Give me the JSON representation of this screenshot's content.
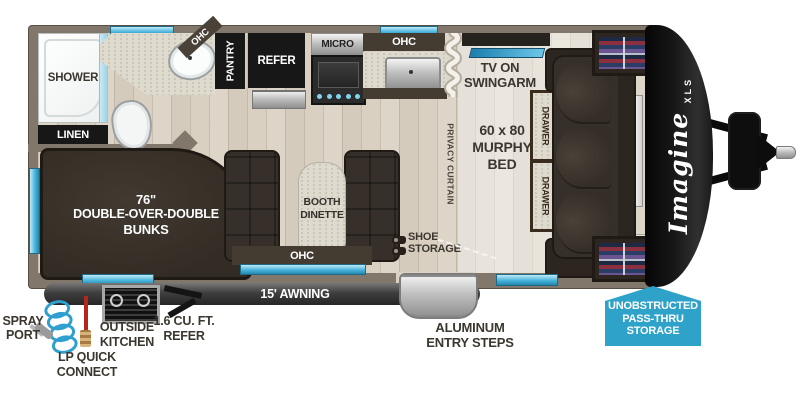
{
  "labels": {
    "shower": "SHOWER",
    "linen": "LINEN",
    "bath_ohc": "OHC",
    "pantry": "PANTRY",
    "refer": "REFER",
    "micro": "MICRO",
    "kitchen_ohc": "OHC",
    "privacy": "PRIVACY CURTAIN",
    "tv": [
      "TV ON",
      "SWINGARM"
    ],
    "murphy": [
      "60 x 80",
      "MURPHY",
      "BED"
    ],
    "drawer": "DRAWER",
    "bunks": [
      "76\"",
      "DOUBLE-OVER-DOUBLE",
      "BUNKS"
    ],
    "booth": [
      "BOOTH",
      "DINETTE"
    ],
    "dinette_ohc": "OHC",
    "shoe": [
      "SHOE",
      "STORAGE"
    ],
    "awning": "15' AWNING"
  },
  "exterior": {
    "spray": [
      "SPRAY",
      "PORT"
    ],
    "lp": [
      "LP QUICK",
      "CONNECT"
    ],
    "outside_kitchen": [
      "OUTSIDE",
      "KITCHEN"
    ],
    "outside_refer": [
      "1.6 CU. FT.",
      "REFER"
    ],
    "steps": [
      "ALUMINUM",
      "ENTRY STEPS"
    ],
    "passthru": [
      "UNOBSTRUCTED",
      "PASS-THRU",
      "STORAGE"
    ]
  },
  "brand": {
    "name": "Imagine",
    "sub": "XLS"
  },
  "colors": {
    "window_blue": "#2ea2c9",
    "sign_blue": "#2ea2c9",
    "wall": "#81776a",
    "furniture_dark": "#37302a"
  }
}
